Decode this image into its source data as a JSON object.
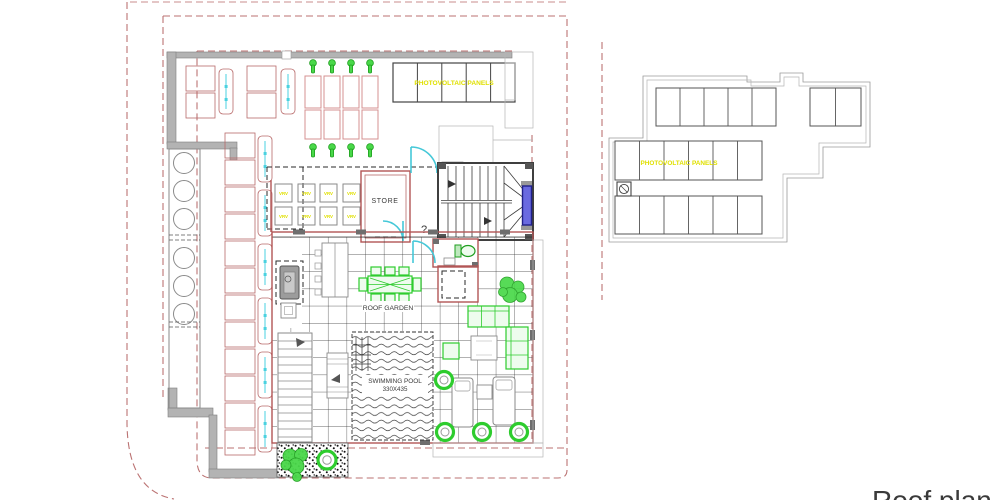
{
  "drawing": {
    "title": "Roof plan",
    "plans": {
      "left": "furnished roof terrace plan with roof garden, swimming pool and photovoltaic panels",
      "right": "upper roof plan with photovoltaic panel arrays"
    },
    "labels": {
      "photovoltaic_panels_left": "PHOTOVOLTAIC PANELS",
      "photovoltaic_panels_right": "PHOTOVOLTAIC PANELS",
      "store": "STORE",
      "roof_garden": "ROOF GARDEN",
      "swimming_pool": "SWIMMING POOL",
      "pool_dimensions": "330X435",
      "question_mark": "?",
      "vrv_unit": "VRV"
    },
    "colors": {
      "boundary_dash_red": "#bb7272",
      "wall_red": "#b25555",
      "wall_gray": "#b3b3b3",
      "annotation_yellow": "#e0e000",
      "plant_green": "#2ecc2e",
      "door_cyan": "#45c8d8",
      "lift_blue": "#4444cc",
      "pergola_pink": "#d49090"
    }
  }
}
